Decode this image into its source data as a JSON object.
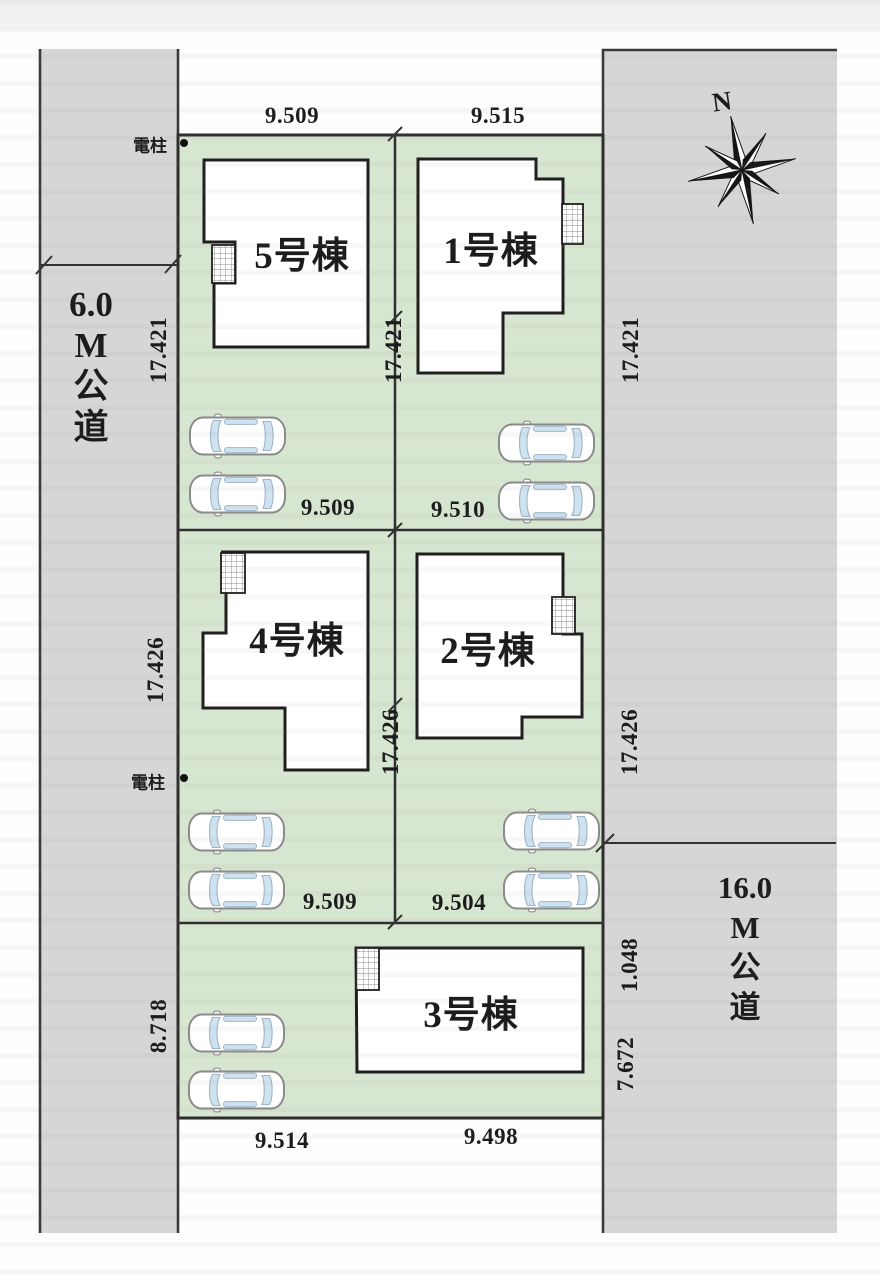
{
  "colors": {
    "lot_green": "#d7e6d0",
    "road_gray": "#d6d6d6",
    "outline": "#2e2e2e",
    "building_outline": "#1f1f1f",
    "glass_blue": "#cfe2ef",
    "text": "#1c1c1c"
  },
  "compass": {
    "label": "N"
  },
  "roads": {
    "left": {
      "width_label_lines": [
        "6.0",
        "M",
        "公",
        "道"
      ]
    },
    "right": {
      "width_label_lines": [
        "16.0",
        "M",
        "公",
        "道"
      ]
    }
  },
  "poles": {
    "top": "電柱",
    "middle": "電柱"
  },
  "buildings": {
    "b5": "5号棟",
    "b1": "1号棟",
    "b4": "4号棟",
    "b2": "2号棟",
    "b3": "3号棟"
  },
  "dimensions": {
    "top_left": "9.509",
    "top_right": "9.515",
    "row1_left": "9.509",
    "row1_right": "9.510",
    "row2_left": "9.509",
    "row2_right": "9.504",
    "bottom_left": "9.514",
    "bottom_right": "9.498",
    "left_upper": "17.421",
    "left_middle": "17.426",
    "left_lower": "8.718",
    "center_upper": "17.421",
    "center_middle": "17.426",
    "right_upper": "17.421",
    "right_middle": "17.426",
    "right_small_upper": "1.048",
    "right_small_lower": "7.672"
  }
}
